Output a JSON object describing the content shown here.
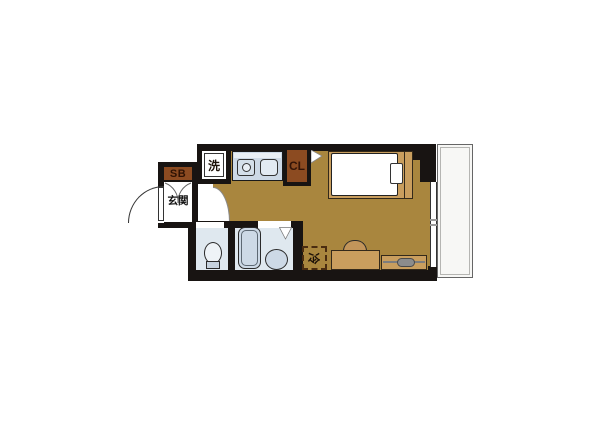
{
  "colors": {
    "wall": "#181412",
    "floor": "#a9863e",
    "wood": "#c99e5e",
    "storage": "#8c4b21",
    "fixture": "#cdd9e6",
    "room_blue": "#dfe8ef",
    "balcony": "#f7f7f5"
  },
  "labels": {
    "shoe_box": "SB",
    "entrance": "玄関",
    "washer": "洗",
    "closet": "CL",
    "refrigerator": "冷"
  }
}
